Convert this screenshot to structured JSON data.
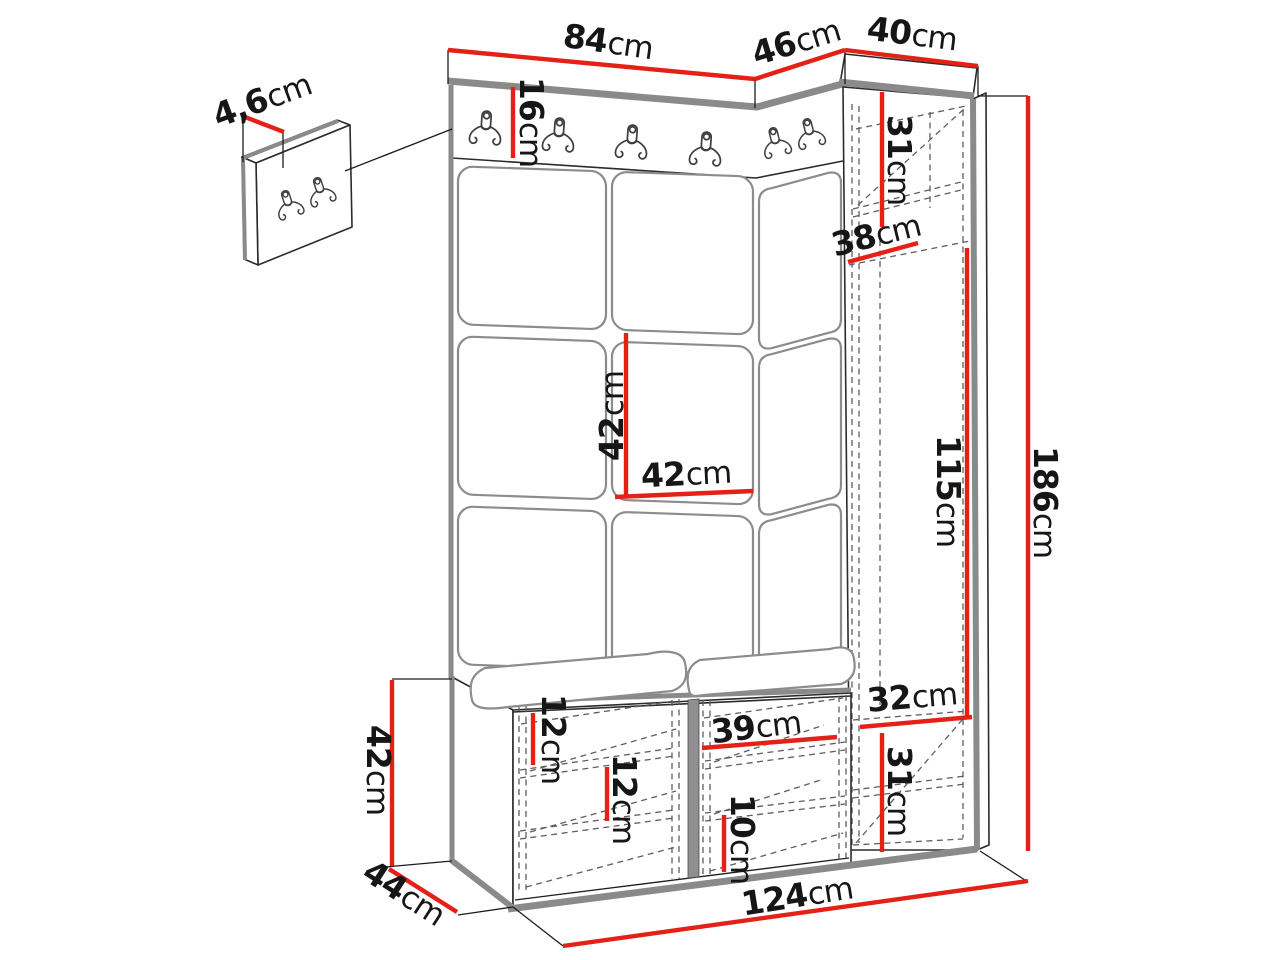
{
  "diagram": {
    "type": "furniture-dimension-drawing",
    "subject": "hallway wardrobe set with hook rail, upholstered panels, tall cabinet and shoe bench"
  },
  "colors": {
    "dimension_red": "#e42116",
    "edge_gray": "#8a8a8a",
    "line_dark": "#2b2b2b"
  },
  "icons": {
    "coat_hook": "double-prong-wall-hook"
  },
  "labels": {
    "panel_width": {
      "value": "84",
      "unit": "cm"
    },
    "corner_section_width": {
      "value": "46",
      "unit": "cm"
    },
    "cabinet_width": {
      "value": "40",
      "unit": "cm"
    },
    "hook_panel_thickness": {
      "value": "4,6",
      "unit": "cm"
    },
    "hook_rail_height": {
      "value": "16",
      "unit": "cm"
    },
    "cabinet_top_compartment_height": {
      "value": "31",
      "unit": "cm"
    },
    "cabinet_depth": {
      "value": "38",
      "unit": "cm"
    },
    "cushion_height": {
      "value": "42",
      "unit": "cm"
    },
    "cushion_width": {
      "value": "42",
      "unit": "cm"
    },
    "cabinet_open_section_height": {
      "value": "115",
      "unit": "cm"
    },
    "total_height": {
      "value": "186",
      "unit": "cm"
    },
    "cabinet_inner_width": {
      "value": "32",
      "unit": "cm"
    },
    "cabinet_bottom_compartment_height": {
      "value": "31",
      "unit": "cm"
    },
    "bench_left_shelf_spacing_top": {
      "value": "12",
      "unit": "cm"
    },
    "bench_left_shelf_spacing_bottom": {
      "value": "12",
      "unit": "cm"
    },
    "bench_right_section_width": {
      "value": "39",
      "unit": "cm"
    },
    "bench_right_shelf_spacing": {
      "value": "10",
      "unit": "cm"
    },
    "bench_height": {
      "value": "42",
      "unit": "cm"
    },
    "bench_depth": {
      "value": "44",
      "unit": "cm"
    },
    "total_width": {
      "value": "124",
      "unit": "cm"
    }
  }
}
